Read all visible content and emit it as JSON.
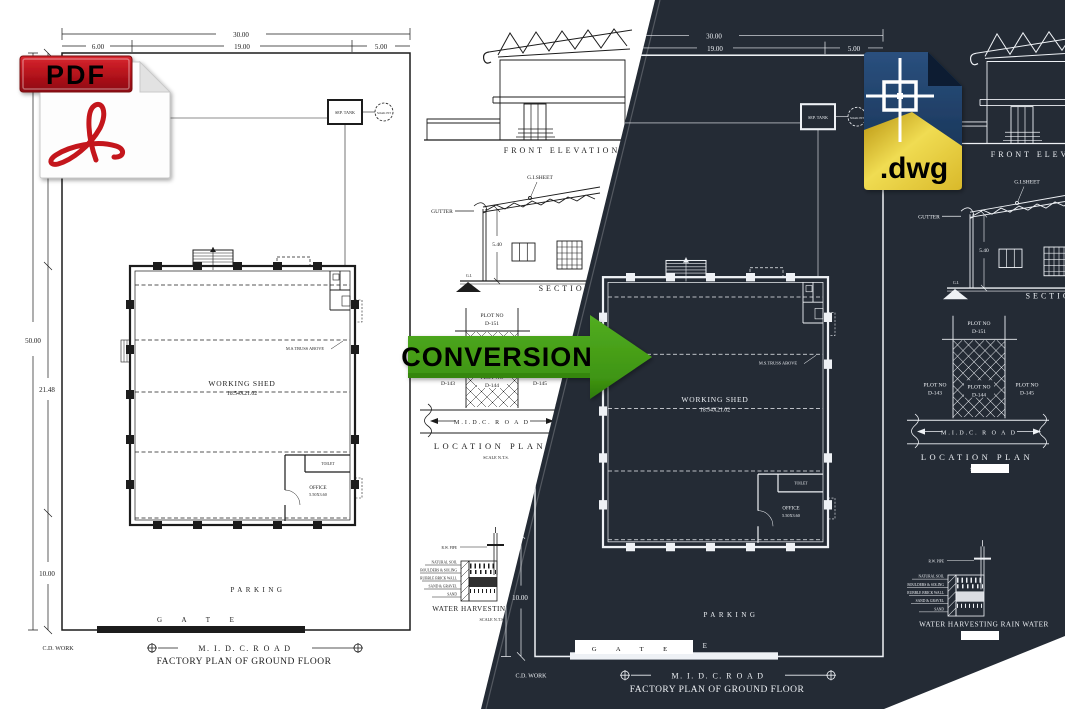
{
  "pdf_icon": {
    "label": "PDF"
  },
  "dwg_icon": {
    "label": ".dwg"
  },
  "arrow": {
    "label": "CONVERSION",
    "color": "#46a018"
  },
  "colors": {
    "dark_bg": "#242b35",
    "ink_dark": "#1c1c1c",
    "ink_light": "#eef1f5",
    "pdf_red": "#c4161d",
    "dwg_navy": "#1e3c64",
    "dwg_gold": "#e3c52f"
  },
  "drawing": {
    "dims": {
      "overall_width": "30.00",
      "shed_width": "19.00",
      "left_setback": "6.00",
      "right_setback": "5.00",
      "front_setback": "18.52",
      "overall_depth": "50.00",
      "shed_depth": "21.48",
      "rear_setback": "10.00"
    },
    "plan": {
      "working_shed": "WORKING SHED",
      "working_shed_size": "18.54X21.02",
      "truss_note": "M.S.TRUSS ABOVE",
      "office": "OFFICE",
      "office_size": "5.50X3.60",
      "toilet": "TOILET",
      "sep_tank": "SEP. TANK",
      "soak_pit": "SOAK PIT",
      "parking": "PARKING",
      "gate": "G A T E",
      "cd_work": "C.D. WORK",
      "road": "M. I. D. C.  R O A D",
      "title": "FACTORY PLAN OF GROUND FLOOR"
    },
    "front_elevation": {
      "title": "FRONT ELEVATION"
    },
    "section": {
      "title": "SECTION",
      "gi_sheet": "G.I.SHEET",
      "gutter": "GUTTER",
      "gi_label": "G.I.",
      "eave_height": "5.40"
    },
    "location_plan": {
      "plot_no": "PLOT NO",
      "plot_main": "D-151",
      "plot_left": "D-143",
      "plot_center": "D-144",
      "plot_right": "D-145",
      "road": "M.I.D.C.  R O A D",
      "title": "LOCATION PLAN",
      "scale": "SCALE N.T.S."
    },
    "water_harvesting": {
      "title": "WATER HARVESTING RAIN WATER",
      "scale": "SCALE N.T.S.",
      "pipe_label": "R.W. PIPE",
      "layer_labels": [
        "NATURAL SOIL",
        "BOULDERS & SOLING",
        "RUBBLE BRICK WALL",
        "SAND & GRAVEL",
        "SAND"
      ]
    }
  }
}
